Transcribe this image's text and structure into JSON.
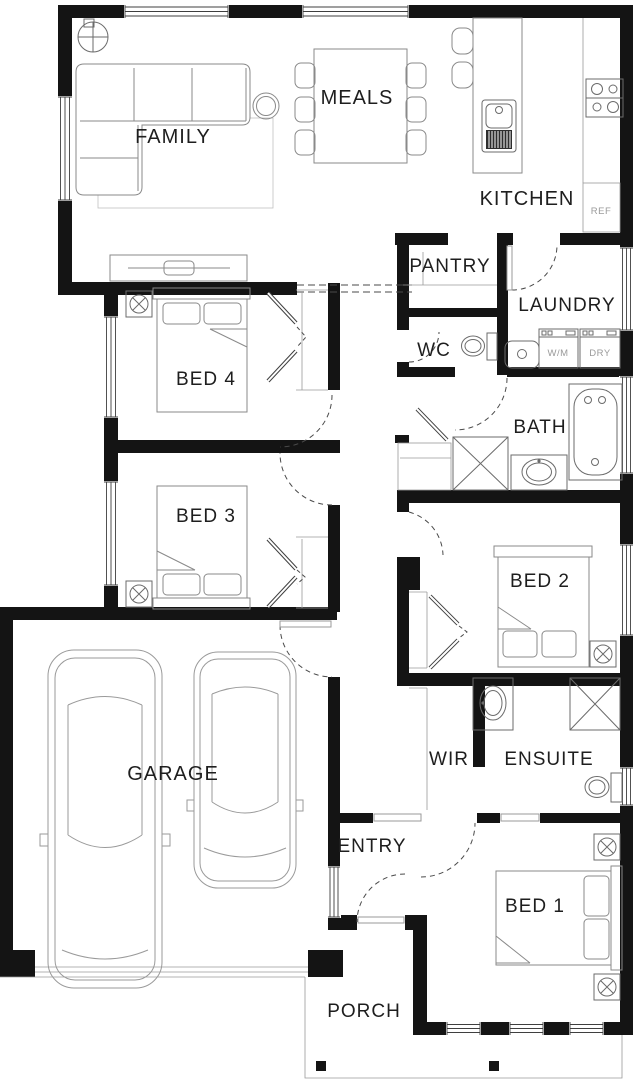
{
  "plan": {
    "type": "residential-floor-plan",
    "rooms": [
      {
        "id": "family",
        "label": "FAMILY"
      },
      {
        "id": "meals",
        "label": "MEALS"
      },
      {
        "id": "kitchen",
        "label": "KITCHEN"
      },
      {
        "id": "pantry",
        "label": "PANTRY"
      },
      {
        "id": "laundry",
        "label": "LAUNDRY"
      },
      {
        "id": "wc",
        "label": "WC"
      },
      {
        "id": "bath",
        "label": "BATH"
      },
      {
        "id": "bed4",
        "label": "BED 4"
      },
      {
        "id": "bed3",
        "label": "BED 3"
      },
      {
        "id": "bed2",
        "label": "BED 2"
      },
      {
        "id": "garage",
        "label": "GARAGE"
      },
      {
        "id": "wir",
        "label": "WIR"
      },
      {
        "id": "ensuite",
        "label": "ENSUITE"
      },
      {
        "id": "entry",
        "label": "ENTRY"
      },
      {
        "id": "bed1",
        "label": "BED 1"
      },
      {
        "id": "porch",
        "label": "PORCH"
      }
    ],
    "appliances": {
      "fridge": "REF",
      "washer": "W/M",
      "dryer": "DRY"
    },
    "colors": {
      "wall": "#141414",
      "background": "#ffffff",
      "furniture_line": "#8a8a8a",
      "fixture_line": "#6b6b6b",
      "label": "#1e1e1e",
      "muted_label": "#9a9a9a"
    }
  }
}
